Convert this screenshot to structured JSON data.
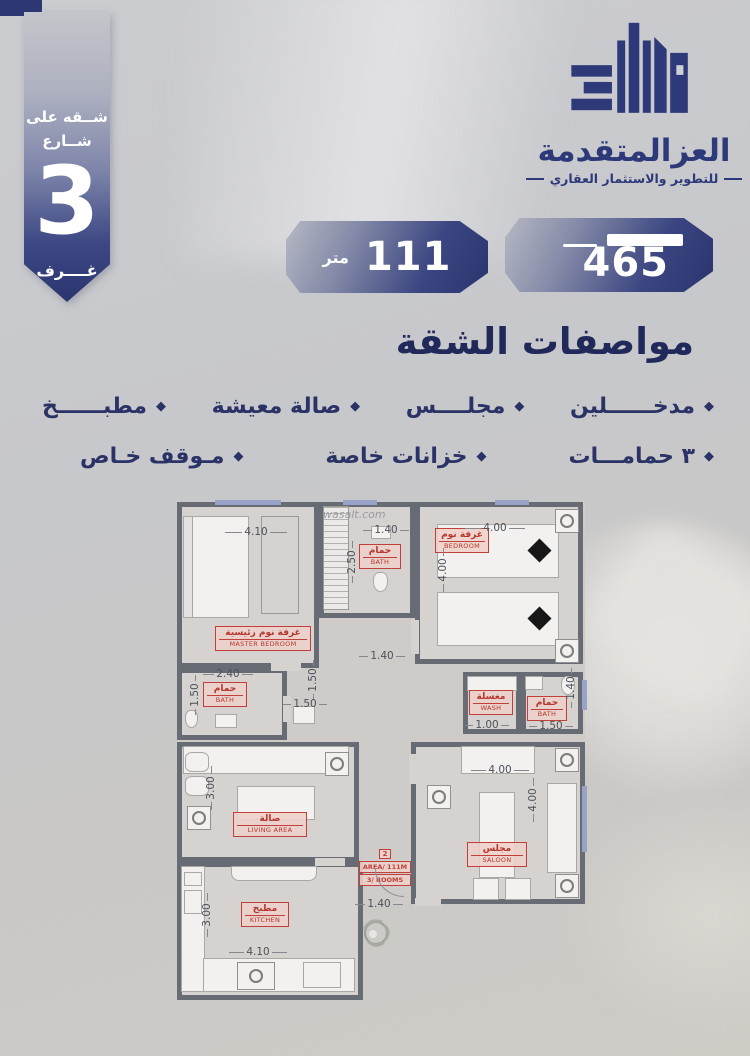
{
  "ribbon": {
    "line1": "شــقه على",
    "line2": "شــارع",
    "count": "3",
    "label": "غــــرف"
  },
  "logo": {
    "title": "العزالمتقدمة",
    "tagline": "للتطوير والاستثمار العقاري"
  },
  "badges": {
    "area": {
      "value": "111",
      "unit": "متر"
    },
    "price": {
      "value": "465"
    }
  },
  "specs": {
    "title": "مواصفات الشقة",
    "row1": [
      "مدخــــــلين",
      "مجلــــس",
      "صالة معيشة",
      "مطبــــــخ"
    ],
    "row2": [
      "٣ حمامـــات",
      "خزانات خاصة",
      "مـوقف خـاص"
    ]
  },
  "floorplan": {
    "watermark": "wasalt.com",
    "rooms": {
      "master": {
        "ar": "غرفة نوم رئيسية",
        "en": "MASTER BEDROOM"
      },
      "bath_top": {
        "ar": "حمام",
        "en": "BATH"
      },
      "bedroom": {
        "ar": "غرفة نوم",
        "en": "BEDROOM"
      },
      "bath_mid": {
        "ar": "حمام",
        "en": "BATH"
      },
      "wash": {
        "ar": "مغسلة",
        "en": "WASH"
      },
      "bath_right": {
        "ar": "حمام",
        "en": "BATH"
      },
      "living": {
        "ar": "صالة",
        "en": "LIVING AREA"
      },
      "saloon": {
        "ar": "مجلس",
        "en": "SALOON"
      },
      "kitchen": {
        "ar": "مطبخ",
        "en": "KITCHEN"
      }
    },
    "info_box": {
      "line1": "2",
      "line2": "AREA/ 111M",
      "line3": "3/ ROOMS"
    },
    "dims": {
      "master_w": "4.10",
      "bath_top_w": "1.40",
      "bath_top_h": "2.50",
      "bedroom_w": "4.00",
      "bedroom_h": "4.00",
      "hall_w": "1.40",
      "bath_mid_w": "2.40",
      "bath_mid_h": "1.50",
      "corr_h": "1.50",
      "corr_w": "1.50",
      "wash_w": "1.00",
      "bath_right_w": "1.50",
      "bath_right_h": "1.40",
      "living_h": "3.00",
      "saloon_w": "4.00",
      "saloon_h": "4.00",
      "kitchen_h": "3.00",
      "kitchen_w": "4.10",
      "entry_w": "1.40"
    }
  }
}
